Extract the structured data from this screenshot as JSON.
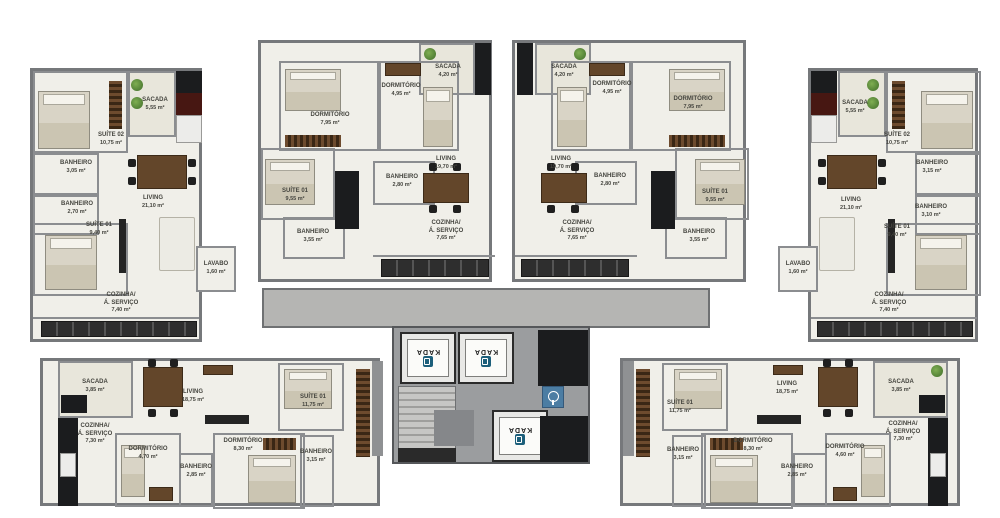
{
  "colors": {
    "wall": "#76787b",
    "floor": "#f0efe9",
    "balcony": "#e8e6db",
    "corridor": "#b5b5b3",
    "core": "#9b9d9f",
    "shaft": "#1b1c1e",
    "elevator_logo_blue": "#1c5f7b",
    "accessibility_sign_blue": "#4c7da3"
  },
  "core": {
    "elevator_label": "KADA"
  },
  "units": [
    {
      "name": "top-left",
      "rooms": [
        {
          "label": "SACADA",
          "area": "5,55 m²"
        },
        {
          "label": "SUÍTE 02",
          "area": "10,75 m²"
        },
        {
          "label": "BANHEIRO",
          "area": "3,05 m²"
        },
        {
          "label": "BANHEIRO",
          "area": "2,70 m²"
        },
        {
          "label": "LIVING",
          "area": "21,10 m²"
        },
        {
          "label": "SUÍTE 01",
          "area": "9,40 m²"
        },
        {
          "label": "LAVABO",
          "area": "1,60 m²"
        },
        {
          "label": "COZINHA/\nÁ. SERVIÇO",
          "area": "7,40 m²"
        }
      ]
    },
    {
      "name": "top-center-left",
      "rooms": [
        {
          "label": "SACADA",
          "area": "4,20 m²"
        },
        {
          "label": "DORMITÓRIO",
          "area": "4,95 m²"
        },
        {
          "label": "DORMITÓRIO",
          "area": "7,95 m²"
        },
        {
          "label": "LIVING",
          "area": "19,70 m²"
        },
        {
          "label": "BANHEIRO",
          "area": "2,80 m²"
        },
        {
          "label": "SUÍTE 01",
          "area": "9,55 m²"
        },
        {
          "label": "BANHEIRO",
          "area": "3,55 m²"
        },
        {
          "label": "COZINHA/\nÁ. SERVIÇO",
          "area": "7,65 m²"
        }
      ]
    },
    {
      "name": "top-center-right",
      "rooms": [
        {
          "label": "SACADA",
          "area": "4,20 m²"
        },
        {
          "label": "DORMITÓRIO",
          "area": "4,95 m²"
        },
        {
          "label": "DORMITÓRIO",
          "area": "7,95 m²"
        },
        {
          "label": "LIVING",
          "area": "19,70 m²"
        },
        {
          "label": "BANHEIRO",
          "area": "2,80 m²"
        },
        {
          "label": "SUÍTE 01",
          "area": "9,55 m²"
        },
        {
          "label": "BANHEIRO",
          "area": "3,55 m²"
        },
        {
          "label": "COZINHA/\nÁ. SERVIÇO",
          "area": "7,65 m²"
        }
      ]
    },
    {
      "name": "top-right",
      "rooms": [
        {
          "label": "SACADA",
          "area": "5,55 m²"
        },
        {
          "label": "SUÍTE 02",
          "area": "10,75 m²"
        },
        {
          "label": "BANHEIRO",
          "area": "3,15 m²"
        },
        {
          "label": "BANHEIRO",
          "area": "3,10 m²"
        },
        {
          "label": "LIVING",
          "area": "21,10 m²"
        },
        {
          "label": "SUÍTE 01",
          "area": "9,40 m²"
        },
        {
          "label": "LAVABO",
          "area": "1,60 m²"
        },
        {
          "label": "COZINHA/\nÁ. SERVIÇO",
          "area": "7,40 m²"
        }
      ]
    },
    {
      "name": "bottom-left",
      "rooms": [
        {
          "label": "SACADA",
          "area": "3,85 m²"
        },
        {
          "label": "COZINHA/\nÁ. SERVIÇO",
          "area": "7,30 m²"
        },
        {
          "label": "LIVING",
          "area": "18,75 m²"
        },
        {
          "label": "DORMITÓRIO",
          "area": "4,70 m²"
        },
        {
          "label": "SUÍTE 01",
          "area": "11,75 m²"
        },
        {
          "label": "DORMITÓRIO",
          "area": "8,30 m²"
        },
        {
          "label": "BANHEIRO",
          "area": "2,85 m²"
        },
        {
          "label": "BANHEIRO",
          "area": "3,15 m²"
        }
      ]
    },
    {
      "name": "bottom-right",
      "rooms": [
        {
          "label": "LIVING",
          "area": "18,75 m²"
        },
        {
          "label": "SUÍTE 01",
          "area": "11,75 m²"
        },
        {
          "label": "BANHEIRO",
          "area": "3,15 m²"
        },
        {
          "label": "DORMITÓRIO",
          "area": "8,30 m²"
        },
        {
          "label": "BANHEIRO",
          "area": "2,85 m²"
        },
        {
          "label": "DORMITÓRIO",
          "area": "4,60 m²"
        },
        {
          "label": "SACADA",
          "area": "3,85 m²"
        },
        {
          "label": "COZINHA/\nÁ. SERVIÇO",
          "area": "7,30 m²"
        }
      ]
    }
  ]
}
